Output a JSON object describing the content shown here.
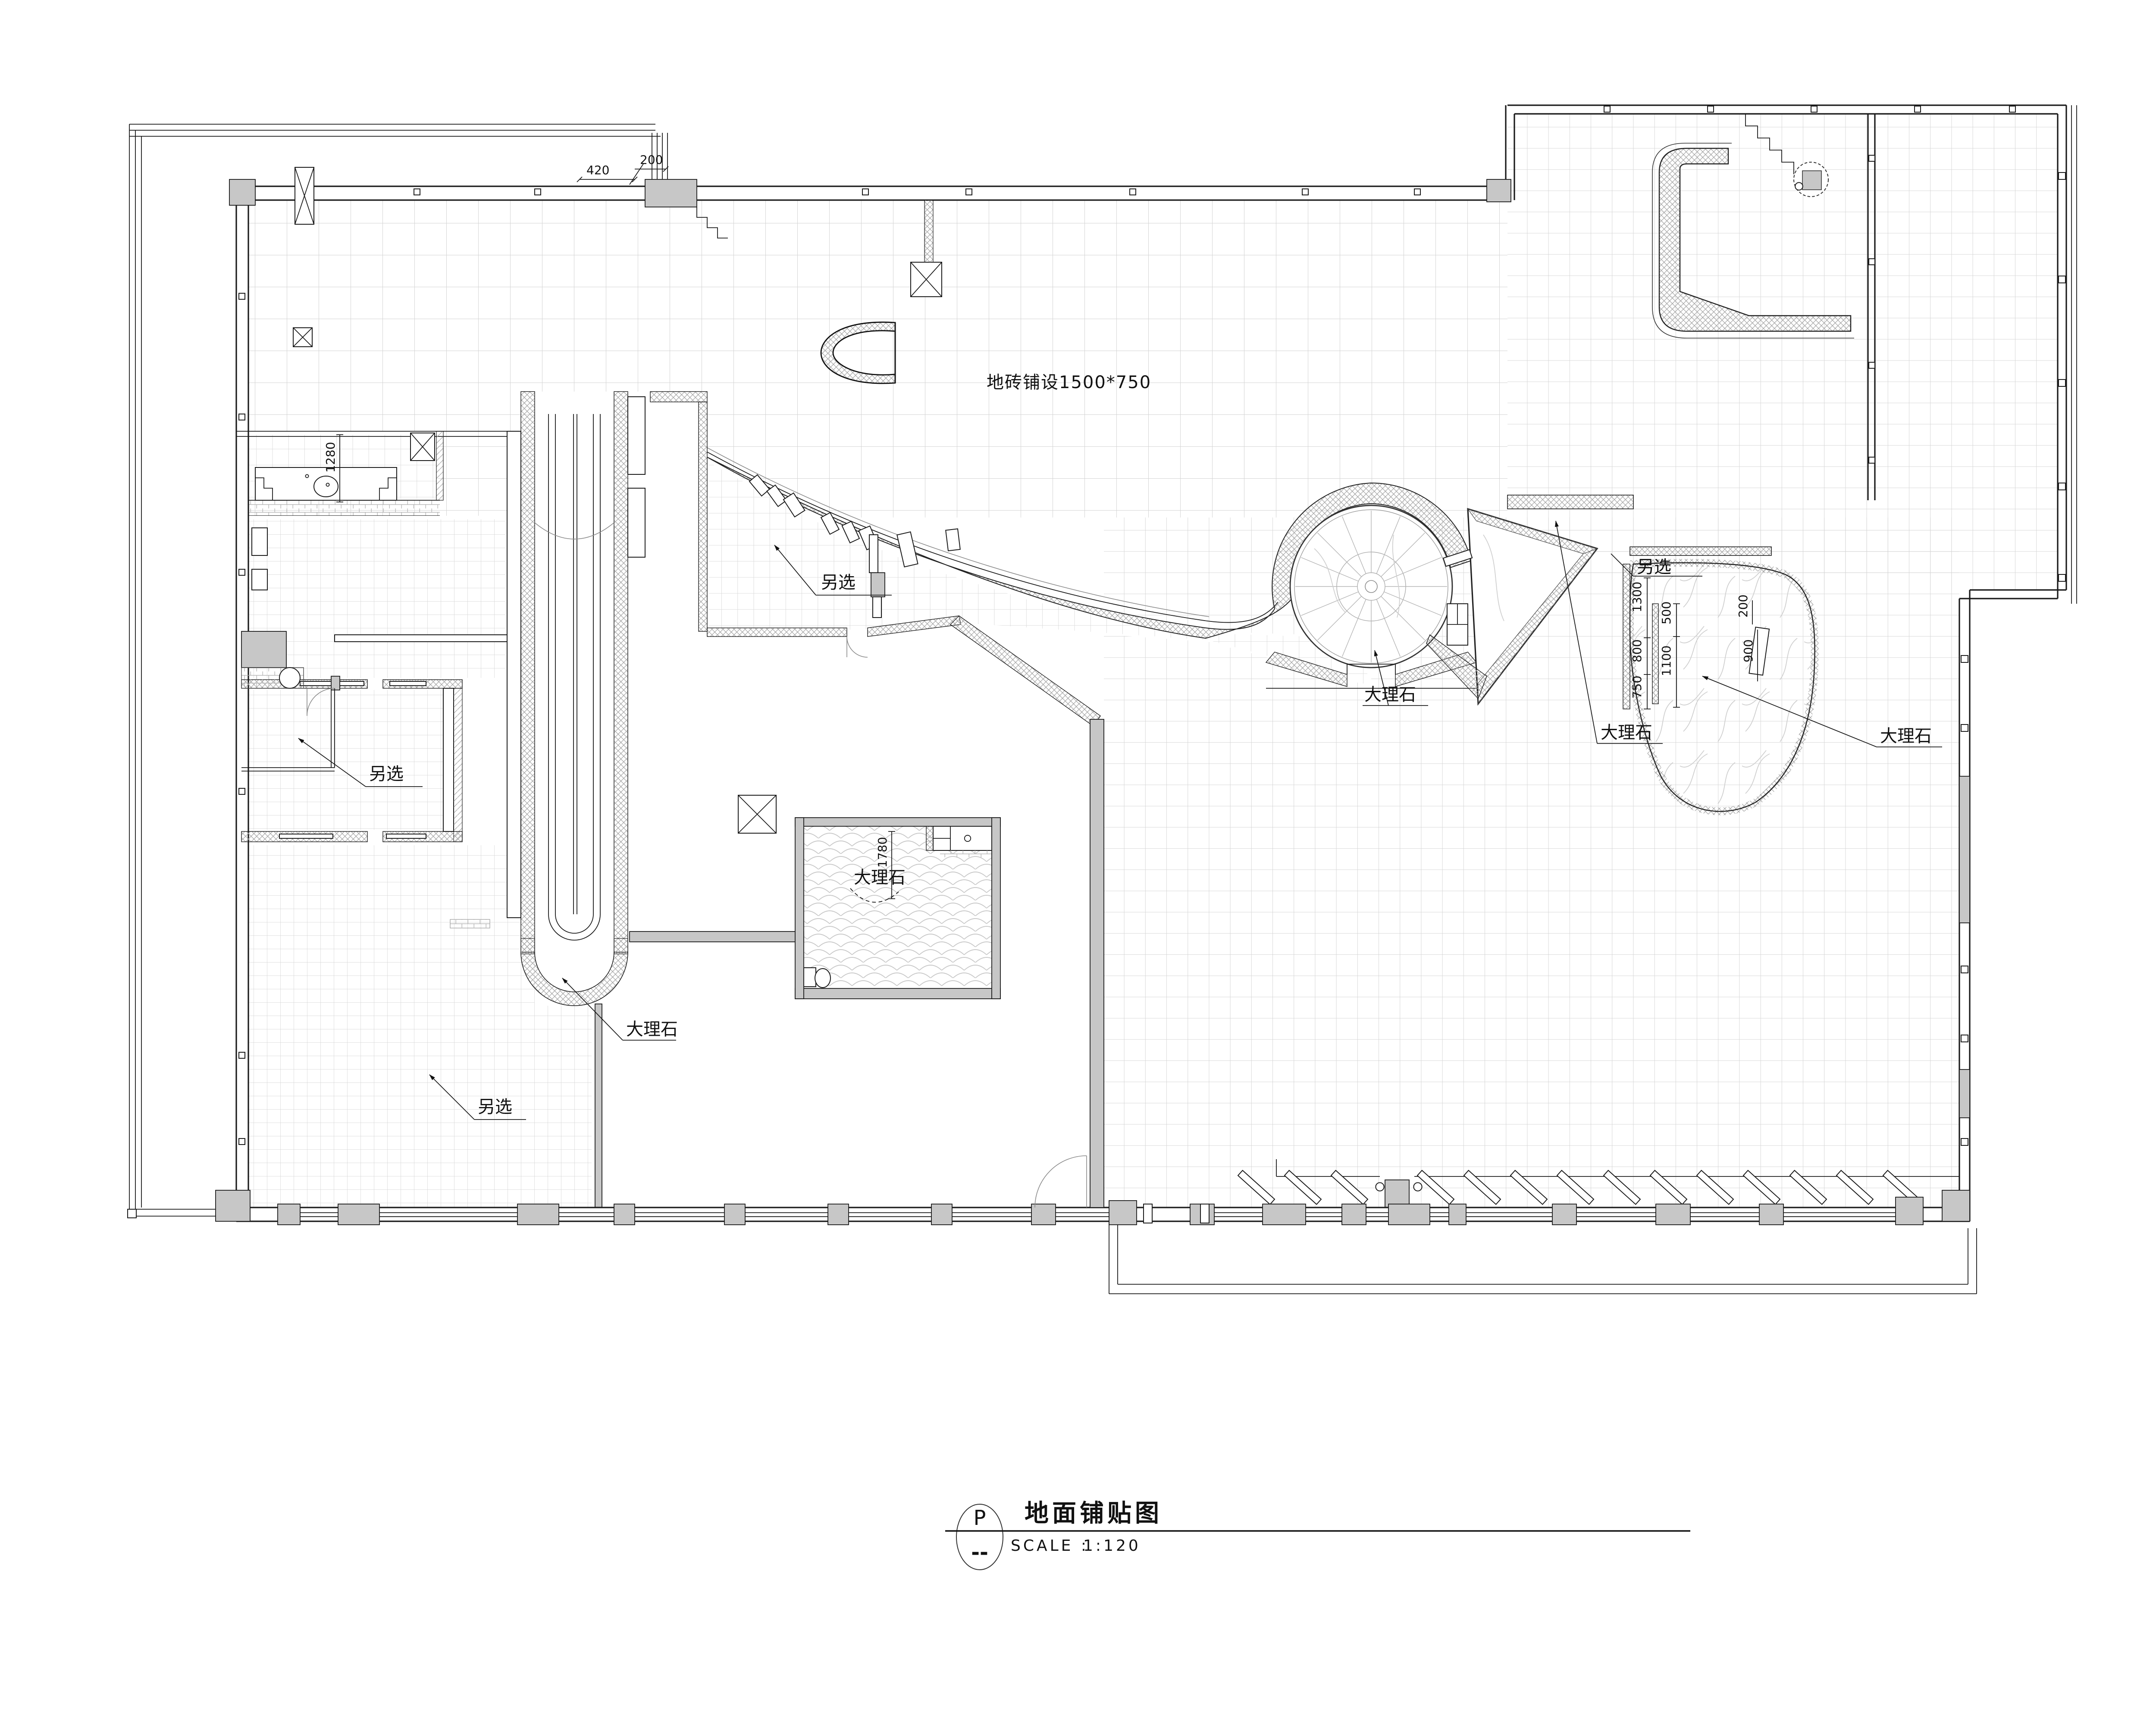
{
  "drawing": {
    "tile_note": "地砖铺设1500*750"
  },
  "labels": {
    "alt_hall": "另选",
    "alt_left_room": "另选",
    "alt_bottom_left": "另选",
    "alt_teardrop": "另选",
    "marble_circle": "大理石",
    "marble_triangle": "大理石",
    "marble_teardrop": "大理石",
    "marble_room": "大理石",
    "marble_escalator": "大理石"
  },
  "dimensions": {
    "top_left_a": "420",
    "top_left_b": "200",
    "bath": "1280",
    "room_height": "1780",
    "td_1300": "1300",
    "td_800": "800",
    "td_750": "750",
    "td_500": "500",
    "td_1100": "1100",
    "td_200": "200",
    "td_900": "900"
  },
  "title_block": {
    "symbol_top": "P",
    "symbol_bottom": "--",
    "title": "地面铺贴图",
    "scale_label": "SCALE :",
    "scale_value": "1:120"
  },
  "colors": {
    "line": "#1a1a1a",
    "grid": "#d4d4d4",
    "column_fill": "#c7c7c7",
    "hatch": "#9f9f9f",
    "background": "#ffffff"
  }
}
